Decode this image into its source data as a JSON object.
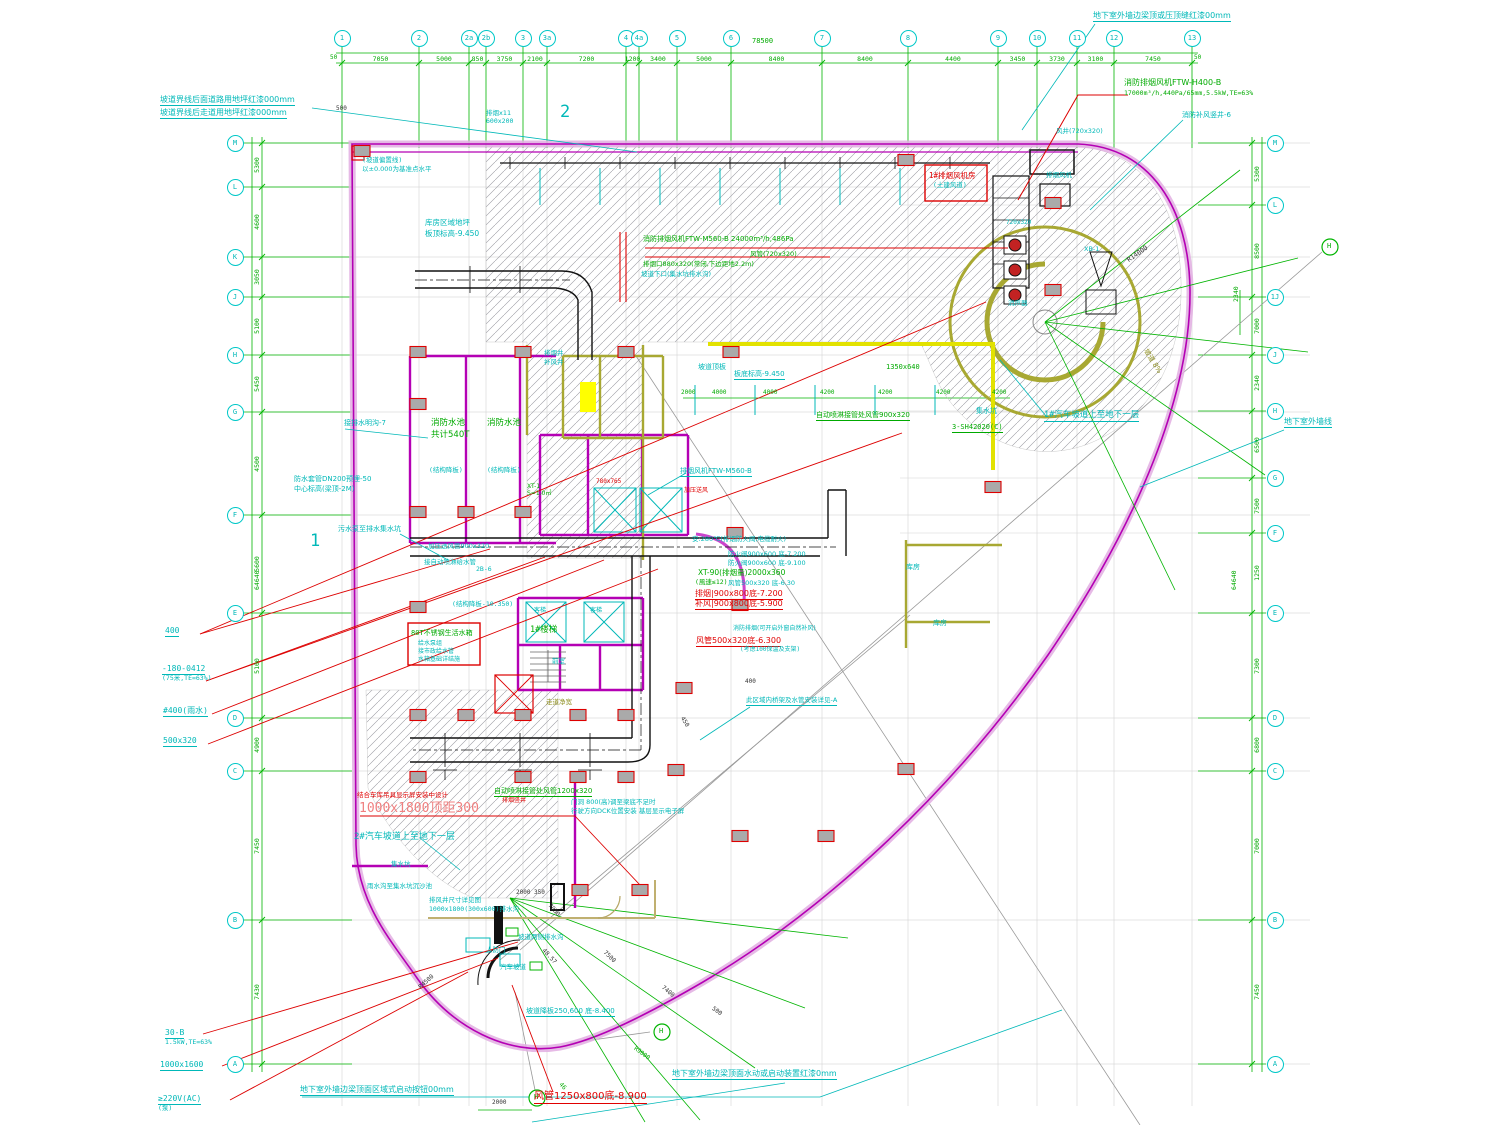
{
  "colors": {
    "cy": "#00b8b8",
    "re": "#e00000",
    "re2": "#f08080",
    "gr": "#00aa00",
    "ol": "#8f8f20",
    "bk": "#333333",
    "mg": "#bb00bb"
  },
  "axes": {
    "top": {
      "bubble_y": 38,
      "total": "78500",
      "total_x": 752,
      "total_y": 38,
      "bubbles": [
        {
          "label": "1",
          "x": 342
        },
        {
          "label": "2",
          "x": 419
        },
        {
          "label": "2a",
          "x": 469
        },
        {
          "label": "2b",
          "x": 486
        },
        {
          "label": "3",
          "x": 523
        },
        {
          "label": "3a",
          "x": 547
        },
        {
          "label": "4",
          "x": 626
        },
        {
          "label": "4a",
          "x": 639
        },
        {
          "label": "5",
          "x": 677
        },
        {
          "label": "6",
          "x": 731
        },
        {
          "label": "7",
          "x": 822
        },
        {
          "label": "8",
          "x": 908
        },
        {
          "label": "9",
          "x": 998
        },
        {
          "label": "10",
          "x": 1037
        },
        {
          "label": "11",
          "x": 1077
        },
        {
          "label": "12",
          "x": 1114
        },
        {
          "label": "13",
          "x": 1192
        }
      ],
      "dims": [
        "7050",
        "5000",
        "850",
        "3750",
        "2100",
        "7200",
        "1200",
        "3400",
        "5000",
        "8400",
        "8400",
        "4400",
        "3450",
        "3730",
        "3100",
        "7450"
      ]
    },
    "left": {
      "x": 235,
      "bubbles": [
        {
          "label": "M",
          "y": 143
        },
        {
          "label": "L",
          "y": 187
        },
        {
          "label": "K",
          "y": 257
        },
        {
          "label": "J",
          "y": 297
        },
        {
          "label": "H",
          "y": 355
        },
        {
          "label": "G",
          "y": 412
        },
        {
          "label": "F",
          "y": 515
        },
        {
          "label": "E",
          "y": 613
        },
        {
          "label": "D",
          "y": 718
        },
        {
          "label": "C",
          "y": 771
        },
        {
          "label": "B",
          "y": 920
        },
        {
          "label": "A",
          "y": 1064
        }
      ],
      "dims": [
        "5300",
        "4600",
        "3050",
        "5100",
        "5450",
        "4500",
        "5600",
        "5100",
        "4900",
        "7450",
        "7430"
      ],
      "total": "64640"
    },
    "right": {
      "x": 1275,
      "bubbles": [
        {
          "label": "M",
          "y": 143
        },
        {
          "label": "L",
          "y": 205
        },
        {
          "label": "1J",
          "y": 297
        },
        {
          "label": "J",
          "y": 355
        },
        {
          "label": "H",
          "y": 411
        },
        {
          "label": "G",
          "y": 478
        },
        {
          "label": "F",
          "y": 533
        },
        {
          "label": "E",
          "y": 613
        },
        {
          "label": "D",
          "y": 718
        },
        {
          "label": "C",
          "y": 771
        },
        {
          "label": "B",
          "y": 920
        },
        {
          "label": "A",
          "y": 1064
        }
      ],
      "dims": [
        "5300",
        "8500",
        "7000",
        "2340",
        "6500",
        "7500",
        "1250",
        "7300",
        "6800",
        "7000",
        "7450"
      ],
      "total": "64640"
    }
  },
  "h_bubbles": [
    {
      "label": "H",
      "x": 662,
      "y": 1032
    },
    {
      "label": "H",
      "x": 537,
      "y": 1098
    },
    {
      "label": "H",
      "x": 1330,
      "y": 247
    }
  ],
  "columns": [
    [
      362,
      151
    ],
    [
      418,
      352
    ],
    [
      523,
      352
    ],
    [
      626,
      352
    ],
    [
      731,
      352
    ],
    [
      418,
      404
    ],
    [
      418,
      512
    ],
    [
      466,
      512
    ],
    [
      523,
      512
    ],
    [
      418,
      607
    ],
    [
      418,
      715
    ],
    [
      466,
      715
    ],
    [
      523,
      715
    ],
    [
      578,
      715
    ],
    [
      626,
      715
    ],
    [
      418,
      777
    ],
    [
      523,
      777
    ],
    [
      578,
      777
    ],
    [
      626,
      777
    ],
    [
      676,
      770
    ],
    [
      735,
      533
    ],
    [
      740,
      605
    ],
    [
      684,
      688
    ],
    [
      740,
      836
    ],
    [
      826,
      836
    ],
    [
      580,
      890
    ],
    [
      640,
      890
    ],
    [
      906,
      769
    ],
    [
      993,
      487
    ],
    [
      1053,
      203
    ],
    [
      1053,
      290
    ],
    [
      906,
      160
    ]
  ],
  "annotations": [
    {
      "t": "坡道界线后面道路用地坪红漆000mm",
      "x": 160,
      "y": 96,
      "c": "cy",
      "s": 8,
      "u": 1
    },
    {
      "t": "坡道界线后走道用地坪红漆000mm",
      "x": 160,
      "y": 109,
      "c": "cy",
      "s": 8,
      "u": 1
    },
    {
      "t": "地下室外墙边梁顶或压顶缝红漆00mm",
      "x": 1093,
      "y": 12,
      "c": "cy",
      "s": 8,
      "u": 1
    },
    {
      "t": "消防排烟风机FTW-H400-B",
      "x": 1124,
      "y": 79,
      "c": "gr",
      "s": 8
    },
    {
      "t": "17000m³/h,440Pa/65mm,5.5kW,TE=63%",
      "x": 1124,
      "y": 90,
      "c": "gr",
      "s": 6.5
    },
    {
      "t": "消防补风竖井-6",
      "x": 1182,
      "y": 112,
      "c": "cy",
      "s": 7
    },
    {
      "t": "风井(720x320)",
      "x": 1056,
      "y": 128,
      "c": "cy",
      "s": 6.5
    },
    {
      "t": "排烟x11",
      "x": 486,
      "y": 110,
      "c": "cy",
      "s": 6.5
    },
    {
      "t": "600x200",
      "x": 486,
      "y": 118,
      "c": "cy",
      "s": 6.5
    },
    {
      "t": "2",
      "x": 560,
      "y": 104,
      "c": "cy",
      "s": 17
    },
    {
      "t": "1",
      "x": 310,
      "y": 533,
      "c": "cy",
      "s": 17
    },
    {
      "t": "(坡道偏置线)",
      "x": 362,
      "y": 157,
      "c": "cy",
      "s": 6.5
    },
    {
      "t": "以±0.000为基准点水平",
      "x": 362,
      "y": 166,
      "c": "cy",
      "s": 6.5
    },
    {
      "t": "库房区域地坪",
      "x": 425,
      "y": 219,
      "c": "cy",
      "s": 7.5
    },
    {
      "t": "板顶标高-9.450",
      "x": 425,
      "y": 230,
      "c": "cy",
      "s": 7.5
    },
    {
      "t": "1#排烟风机房",
      "x": 929,
      "y": 172,
      "c": "re",
      "s": 7.5
    },
    {
      "t": "(土建风道)",
      "x": 933,
      "y": 182,
      "c": "cy",
      "s": 6.5
    },
    {
      "t": "排烟风机",
      "x": 1046,
      "y": 172,
      "c": "cy",
      "s": 6.5
    },
    {
      "t": "720x320",
      "x": 1006,
      "y": 220,
      "c": "cy",
      "s": 6
    },
    {
      "t": "消声器",
      "x": 1008,
      "y": 300,
      "c": "cy",
      "s": 6.5
    },
    {
      "t": "XB-1",
      "x": 1084,
      "y": 246,
      "c": "cy",
      "s": 6.5
    },
    {
      "t": "R14000",
      "x": 1126,
      "y": 258,
      "c": "bk",
      "s": 6.5,
      "r": -35
    },
    {
      "t": "坡道 8%",
      "x": 1148,
      "y": 348,
      "c": "ol",
      "s": 7,
      "r": 58
    },
    {
      "t": "1#汽车坡道上至地下一层",
      "x": 1044,
      "y": 411,
      "c": "cy",
      "s": 8.5,
      "u": 1
    },
    {
      "t": "集水坑",
      "x": 976,
      "y": 408,
      "c": "cy",
      "s": 7
    },
    {
      "t": "3-SH42020(C)",
      "x": 952,
      "y": 424,
      "c": "gr",
      "s": 7,
      "u": 1
    },
    {
      "t": "消防排烟风机FTW-M560-B 24000m³/h,486Pa",
      "x": 643,
      "y": 236,
      "c": "gr",
      "s": 7
    },
    {
      "t": "风管(720x320)",
      "x": 750,
      "y": 251,
      "c": "gr",
      "s": 6.5
    },
    {
      "t": "排烟口880x320(常闭,下边距地2.2m)",
      "x": 643,
      "y": 261,
      "c": "gr",
      "s": 6.5
    },
    {
      "t": "坡道下口(集水坑排水沟)",
      "x": 641,
      "y": 271,
      "c": "cy",
      "s": 6.5
    },
    {
      "t": "坡道顶板",
      "x": 698,
      "y": 364,
      "c": "cy",
      "s": 7
    },
    {
      "t": "板底标高-9.450",
      "x": 734,
      "y": 371,
      "c": "cy",
      "s": 7,
      "u": 1
    },
    {
      "t": "1350x640",
      "x": 886,
      "y": 364,
      "c": "gr",
      "s": 7
    },
    {
      "t": "2000",
      "x": 681,
      "y": 390,
      "c": "gr",
      "s": 6
    },
    {
      "t": "4000",
      "x": 712,
      "y": 390,
      "c": "gr",
      "s": 6
    },
    {
      "t": "4000",
      "x": 763,
      "y": 390,
      "c": "gr",
      "s": 6
    },
    {
      "t": "4200",
      "x": 820,
      "y": 390,
      "c": "gr",
      "s": 6
    },
    {
      "t": "4200",
      "x": 878,
      "y": 390,
      "c": "gr",
      "s": 6
    },
    {
      "t": "4200",
      "x": 936,
      "y": 390,
      "c": "gr",
      "s": 6
    },
    {
      "t": "4200",
      "x": 992,
      "y": 390,
      "c": "gr",
      "s": 6
    },
    {
      "t": "自动喷淋接管处风管900x320",
      "x": 816,
      "y": 412,
      "c": "gr",
      "s": 7,
      "u": 1
    },
    {
      "t": "接排水明沟-7",
      "x": 344,
      "y": 420,
      "c": "cy",
      "s": 7
    },
    {
      "t": "消防水池",
      "x": 431,
      "y": 419,
      "c": "gr",
      "s": 8.5
    },
    {
      "t": "共计540T",
      "x": 431,
      "y": 431,
      "c": "gr",
      "s": 8.5
    },
    {
      "t": "消防水池",
      "x": 487,
      "y": 419,
      "c": "gr",
      "s": 8.5
    },
    {
      "t": "(结构降板)",
      "x": 429,
      "y": 467,
      "c": "cy",
      "s": 6.5
    },
    {
      "t": "(结构降板)",
      "x": 487,
      "y": 467,
      "c": "cy",
      "s": 6.5
    },
    {
      "t": "防水套管DN200预埋-50",
      "x": 294,
      "y": 476,
      "c": "cy",
      "s": 7
    },
    {
      "t": "中心标高(梁顶-2M)",
      "x": 294,
      "y": 486,
      "c": "cy",
      "s": 7
    },
    {
      "t": "污水泵至排水集水坑",
      "x": 338,
      "y": 526,
      "c": "cy",
      "s": 7
    },
    {
      "t": "排烟井",
      "x": 544,
      "y": 350,
      "c": "cy",
      "s": 6.5
    },
    {
      "t": "补风井",
      "x": 544,
      "y": 359,
      "c": "cy",
      "s": 6.5
    },
    {
      "t": "XT-1",
      "x": 527,
      "y": 484,
      "c": "gr",
      "s": 6
    },
    {
      "t": "S=1.0㎡",
      "x": 527,
      "y": 491,
      "c": "gr",
      "s": 6
    },
    {
      "t": "780x765",
      "x": 596,
      "y": 479,
      "c": "re",
      "s": 6
    },
    {
      "t": "排烟风机FTW-M560-B",
      "x": 680,
      "y": 468,
      "c": "cy",
      "s": 7,
      "u": 1
    },
    {
      "t": "加压送风",
      "x": 684,
      "y": 488,
      "c": "re",
      "s": 6
    },
    {
      "t": "加压送风管900x320",
      "x": 428,
      "y": 543,
      "c": "cy",
      "s": 6.5
    },
    {
      "t": "接自动喷淋给水管",
      "x": 424,
      "y": 559,
      "c": "cy",
      "s": 6.5
    },
    {
      "t": "2B-6",
      "x": 476,
      "y": 566,
      "c": "cy",
      "s": 6.5
    },
    {
      "t": "1#楼梯",
      "x": 530,
      "y": 626,
      "c": "gr",
      "s": 8.5
    },
    {
      "t": "客梯",
      "x": 534,
      "y": 608,
      "c": "cy",
      "s": 6
    },
    {
      "t": "客梯",
      "x": 590,
      "y": 608,
      "c": "cy",
      "s": 6
    },
    {
      "t": "前室",
      "x": 552,
      "y": 658,
      "c": "cy",
      "s": 6.5
    },
    {
      "t": "(结构降板-10.350)",
      "x": 452,
      "y": 601,
      "c": "cy",
      "s": 6.5
    },
    {
      "t": "80T不锈钢生活水箱",
      "x": 411,
      "y": 630,
      "c": "gr",
      "s": 7
    },
    {
      "t": "给水泵组",
      "x": 418,
      "y": 641,
      "c": "cy",
      "s": 6
    },
    {
      "t": "接市政给水管",
      "x": 418,
      "y": 649,
      "c": "cy",
      "s": 6
    },
    {
      "t": "水箱基础详结施",
      "x": 418,
      "y": 657,
      "c": "cy",
      "s": 6
    },
    {
      "t": "安:280℃(排烟防火阀,电缆耐火)",
      "x": 692,
      "y": 536,
      "c": "cy",
      "s": 6.5
    },
    {
      "t": "防火阀900x600 底-7.200",
      "x": 728,
      "y": 551,
      "c": "cy",
      "s": 6.5
    },
    {
      "t": "防火阀900x600 底-9.100",
      "x": 728,
      "y": 560,
      "c": "cy",
      "s": 6.5
    },
    {
      "t": "XT-90(排烟量)2000x360",
      "x": 698,
      "y": 569,
      "c": "gr",
      "s": 7.5
    },
    {
      "t": "(風速≤12)",
      "x": 695,
      "y": 579,
      "c": "gr",
      "s": 6.5
    },
    {
      "t": "风管500x320 底-6.30",
      "x": 728,
      "y": 580,
      "c": "cy",
      "s": 6.5
    },
    {
      "t": "排烟|900x800底-7.200",
      "x": 695,
      "y": 590,
      "c": "re",
      "s": 8,
      "u": 1
    },
    {
      "t": "补风|900x800底-5.900",
      "x": 695,
      "y": 600,
      "c": "re",
      "s": 8,
      "u": 1
    },
    {
      "t": "库房",
      "x": 906,
      "y": 564,
      "c": "cy",
      "s": 7
    },
    {
      "t": "库房",
      "x": 933,
      "y": 620,
      "c": "cy",
      "s": 7
    },
    {
      "t": "消防排烟(可开启外窗自然补风)",
      "x": 733,
      "y": 626,
      "c": "cy",
      "s": 6
    },
    {
      "t": "风管500x320底-6.300",
      "x": 696,
      "y": 637,
      "c": "re",
      "s": 8,
      "u": 1
    },
    {
      "t": "(考虑100保温及支架)",
      "x": 740,
      "y": 647,
      "c": "cy",
      "s": 6
    },
    {
      "t": "400",
      "x": 745,
      "y": 679,
      "c": "bk",
      "s": 6
    },
    {
      "t": "450",
      "x": 684,
      "y": 716,
      "c": "bk",
      "s": 6,
      "r": 58
    },
    {
      "t": "此区域内桥架及水管安装详见-A",
      "x": 746,
      "y": 697,
      "c": "cy",
      "s": 6.5,
      "u": 1
    },
    {
      "t": "走道净宽",
      "x": 546,
      "y": 699,
      "c": "ol",
      "s": 6.5
    },
    {
      "t": "400",
      "x": 165,
      "y": 627,
      "c": "cy",
      "s": 8,
      "u": 1
    },
    {
      "t": "-180-0412",
      "x": 162,
      "y": 665,
      "c": "cy",
      "s": 8,
      "u": 1
    },
    {
      "t": "(75米,TE=63%)",
      "x": 162,
      "y": 675,
      "c": "cy",
      "s": 6.5
    },
    {
      "t": "#400(雨水)",
      "x": 163,
      "y": 707,
      "c": "cy",
      "s": 8,
      "u": 1
    },
    {
      "t": "500x320",
      "x": 163,
      "y": 737,
      "c": "cy",
      "s": 8,
      "u": 1
    },
    {
      "t": "30-B",
      "x": 165,
      "y": 1029,
      "c": "cy",
      "s": 8,
      "u": 1
    },
    {
      "t": "1.5kW,TE=63%",
      "x": 165,
      "y": 1039,
      "c": "cy",
      "s": 6.5
    },
    {
      "t": "1000x1600",
      "x": 160,
      "y": 1061,
      "c": "cy",
      "s": 8,
      "u": 1
    },
    {
      "t": "≥220V(AC)",
      "x": 158,
      "y": 1095,
      "c": "cy",
      "s": 8,
      "u": 1
    },
    {
      "t": "(泵)",
      "x": 158,
      "y": 1105,
      "c": "cy",
      "s": 6.5
    },
    {
      "t": "自动喷淋接管处风管1200x320",
      "x": 494,
      "y": 788,
      "c": "gr",
      "s": 7,
      "u": 1
    },
    {
      "t": "排烟竖井",
      "x": 502,
      "y": 798,
      "c": "re",
      "s": 6
    },
    {
      "t": "门洞 800(高)调至梁底不足时",
      "x": 571,
      "y": 799,
      "c": "cy",
      "s": 6.5
    },
    {
      "t": "行驶方向DCK位置安装 基层显示电子屏",
      "x": 571,
      "y": 808,
      "c": "cy",
      "s": 6.5
    },
    {
      "t": "结合车库吊具显示屏安装中设计",
      "x": 357,
      "y": 792,
      "c": "re",
      "s": 6.5
    },
    {
      "t": "1000x1800顶距300",
      "x": 359,
      "y": 802,
      "c": "re2",
      "s": 13
    },
    {
      "t": "2#汽车坡道上至地下一层",
      "x": 354,
      "y": 833,
      "c": "cy",
      "s": 9
    },
    {
      "t": "集水坑",
      "x": 391,
      "y": 861,
      "c": "cy",
      "s": 6.5
    },
    {
      "t": "雨水沟至集水坑沉沙池",
      "x": 367,
      "y": 883,
      "c": "cy",
      "s": 6.5
    },
    {
      "t": "排风井尺寸详见图",
      "x": 429,
      "y": 897,
      "c": "cy",
      "s": 6.5
    },
    {
      "t": "1000x1800(300x600)排水沟",
      "x": 429,
      "y": 906,
      "c": "cy",
      "s": 6.5
    },
    {
      "t": "人防门",
      "x": 486,
      "y": 947,
      "c": "cy",
      "s": 6.5
    },
    {
      "t": "坡道两侧排水沟",
      "x": 518,
      "y": 934,
      "c": "cy",
      "s": 6.5
    },
    {
      "t": "48.57",
      "x": 545,
      "y": 948,
      "c": "bk",
      "s": 6,
      "r": 48
    },
    {
      "t": "汽车坡道",
      "x": 500,
      "y": 964,
      "c": "cy",
      "s": 6.5
    },
    {
      "t": "坡道降板250,600 底-8.400",
      "x": 526,
      "y": 1008,
      "c": "cy",
      "s": 7,
      "u": 1
    },
    {
      "t": "风管1250x800底-8.900",
      "x": 534,
      "y": 1092,
      "c": "re",
      "s": 10,
      "u": 1
    },
    {
      "t": "地下室外墙边梁顶面水动或启动装置红漆0mm",
      "x": 672,
      "y": 1070,
      "c": "cy",
      "s": 8,
      "u": 1
    },
    {
      "t": "地下室外墙边梁顶面区域式启动按钮00mm",
      "x": 300,
      "y": 1086,
      "c": "cy",
      "s": 8,
      "u": 1
    },
    {
      "t": "2000",
      "x": 492,
      "y": 1100,
      "c": "bk",
      "s": 6
    },
    {
      "t": "2000 350",
      "x": 516,
      "y": 890,
      "c": "bk",
      "s": 6
    },
    {
      "t": "7050",
      "x": 551,
      "y": 903,
      "c": "bk",
      "s": 6,
      "r": 48
    },
    {
      "t": "7500",
      "x": 606,
      "y": 950,
      "c": "bk",
      "s": 6,
      "r": 44
    },
    {
      "t": "7400",
      "x": 664,
      "y": 985,
      "c": "bk",
      "s": 6,
      "r": 40
    },
    {
      "t": "500",
      "x": 714,
      "y": 1006,
      "c": "bk",
      "s": 6,
      "r": 36
    },
    {
      "t": "R9000",
      "x": 636,
      "y": 1046,
      "c": "gr",
      "s": 6,
      "r": 36
    },
    {
      "t": "R4500",
      "x": 418,
      "y": 986,
      "c": "bk",
      "s": 6,
      "r": -42
    },
    {
      "t": "46",
      "x": 562,
      "y": 1082,
      "c": "gr",
      "s": 6,
      "r": 48
    },
    {
      "t": "地下室外墙线",
      "x": 1284,
      "y": 418,
      "c": "cy",
      "s": 8,
      "u": 1
    },
    {
      "t": "2340",
      "x": 1233,
      "y": 302,
      "c": "gr",
      "s": 6.5,
      "r": -90
    },
    {
      "t": "64640",
      "x": 1231,
      "y": 590,
      "c": "gr",
      "s": 6.5,
      "r": -90
    },
    {
      "t": "64640",
      "x": 254,
      "y": 590,
      "c": "gr",
      "s": 6.5,
      "r": -90
    },
    {
      "t": "78500",
      "x": 752,
      "y": 38,
      "c": "gr",
      "s": 7
    },
    {
      "t": "50",
      "x": 330,
      "y": 55,
      "c": "gr",
      "s": 6
    },
    {
      "t": "50",
      "x": 1194,
      "y": 55,
      "c": "gr",
      "s": 6
    },
    {
      "t": "500",
      "x": 336,
      "y": 106,
      "c": "bk",
      "s": 6
    }
  ]
}
